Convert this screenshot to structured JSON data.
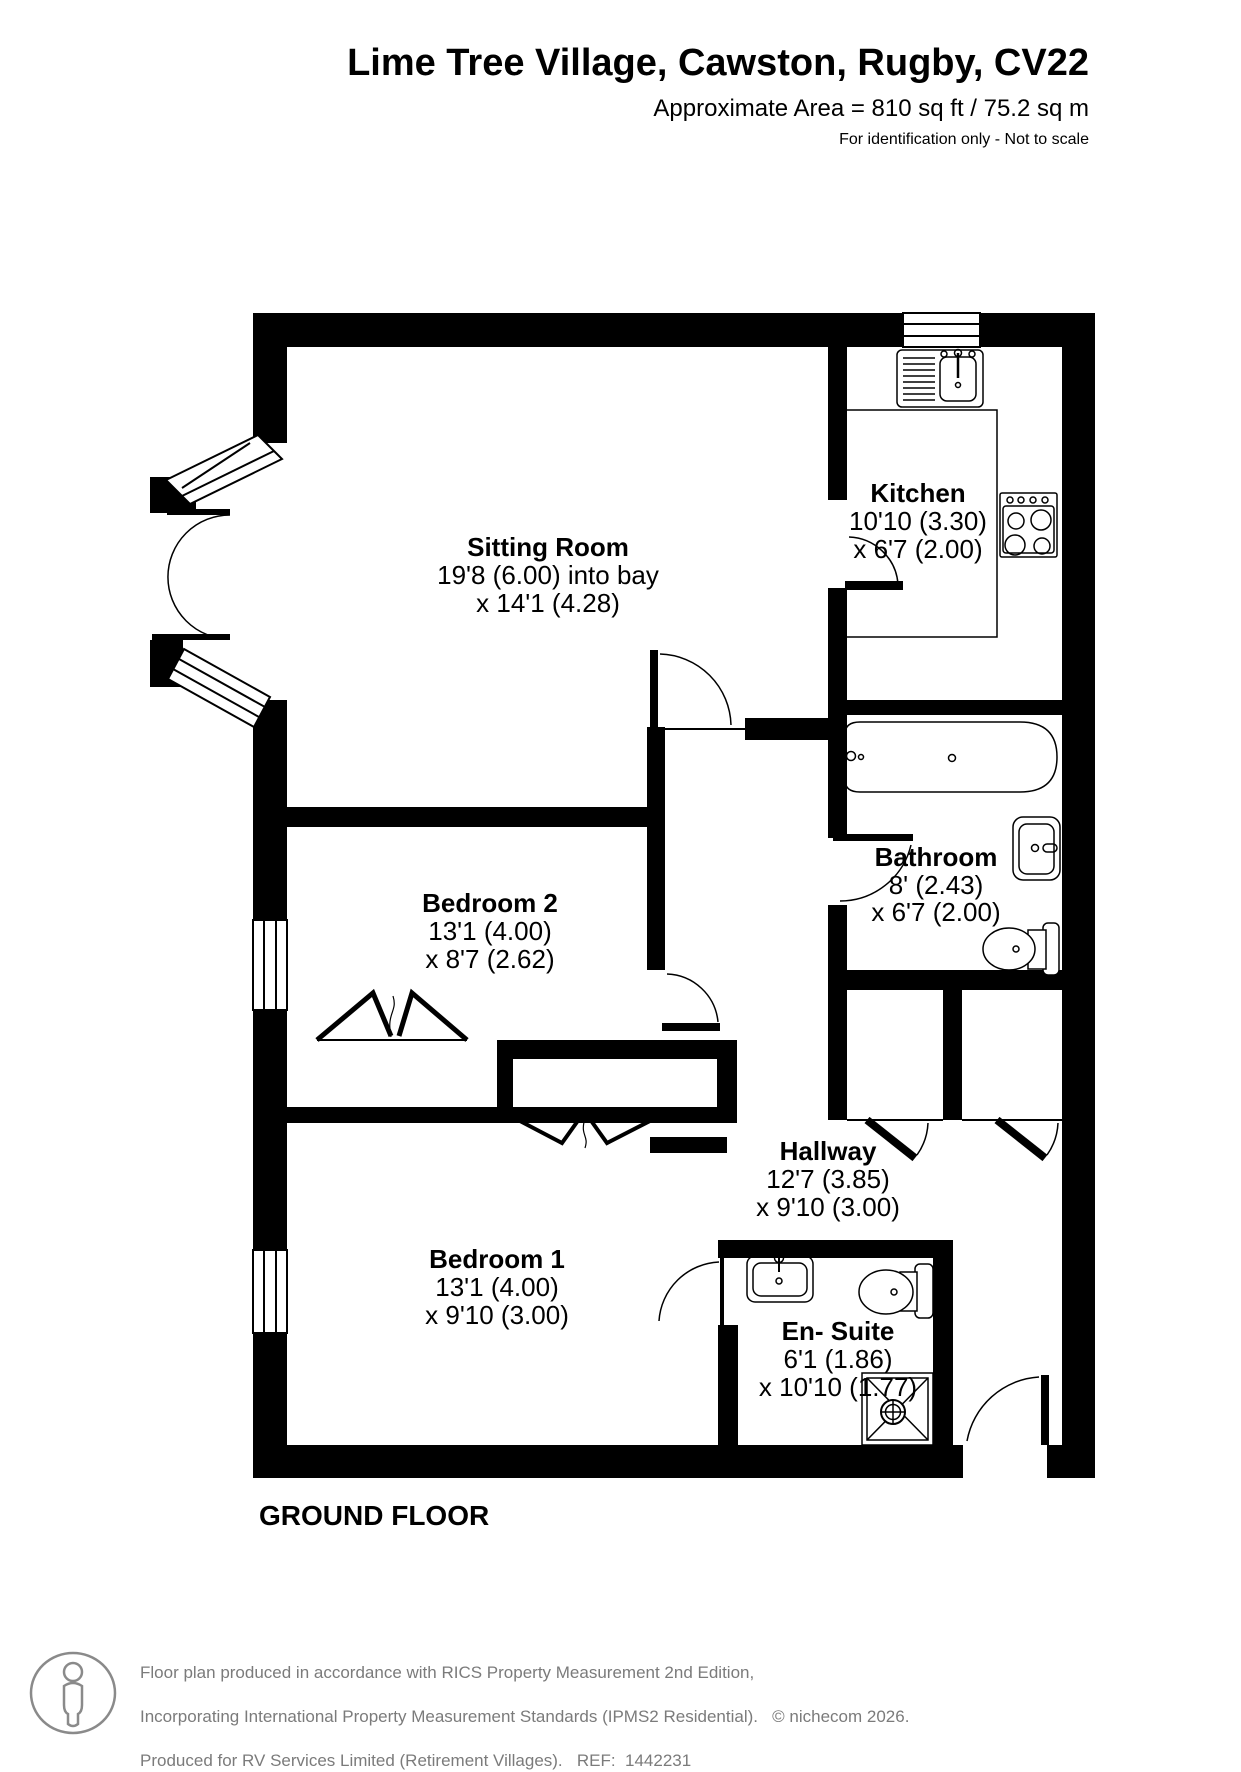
{
  "header": {
    "title": "Lime Tree Village, Cawston, Rugby, CV22",
    "area_line": "Approximate Area = 810 sq ft / 75.2 sq m",
    "note_line": "For identification only - Not to scale"
  },
  "plan": {
    "floor_label": "GROUND FLOOR",
    "rooms": [
      {
        "id": "sitting-room",
        "name": "Sitting Room",
        "dim1": "19'8 (6.00) into bay",
        "dim2": "x 14'1 (4.28)"
      },
      {
        "id": "kitchen",
        "name": "Kitchen",
        "dim1": "10'10 (3.30)",
        "dim2": "x 6'7 (2.00)"
      },
      {
        "id": "bathroom",
        "name": "Bathroom",
        "dim1": "8' (2.43)",
        "dim2": "x 6'7 (2.00)"
      },
      {
        "id": "bedroom-2",
        "name": "Bedroom 2",
        "dim1": "13'1 (4.00)",
        "dim2": "x 8'7 (2.62)"
      },
      {
        "id": "hallway",
        "name": "Hallway",
        "dim1": "12'7 (3.85)",
        "dim2": "x 9'10 (3.00)"
      },
      {
        "id": "bedroom-1",
        "name": "Bedroom 1",
        "dim1": "13'1 (4.00)",
        "dim2": "x 9'10 (3.00)"
      },
      {
        "id": "en-suite",
        "name": "En- Suite",
        "dim1": "6'1 (1.86)",
        "dim2": "x 10'10 (1.77)"
      }
    ]
  },
  "footer": {
    "line1": "Floor plan produced in accordance with RICS Property Measurement 2nd Edition,",
    "line2": "Incorporating International Property Measurement Standards (IPMS2 Residential).   © nichecom 2026.",
    "line3": "Produced for RV Services Limited (Retirement Villages).   REF:  1442231"
  }
}
